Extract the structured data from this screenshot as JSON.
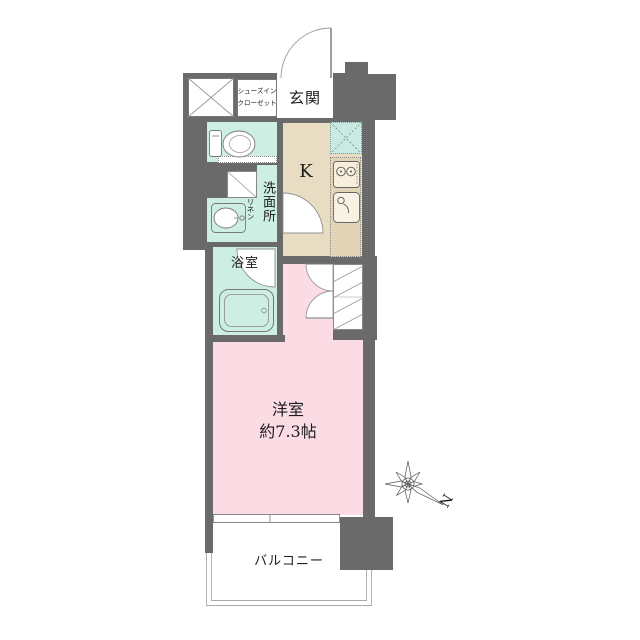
{
  "plan_title": "1K apartment floor plan",
  "labels": {
    "shoe_closet_line1": "シューズイン",
    "shoe_closet_line2": "クローゼット",
    "entrance": "玄関",
    "kitchen": "K",
    "washroom": "洗面所",
    "linen": "リネン",
    "bathroom": "浴室",
    "room_name": "洋室",
    "room_size": "約7.3帖",
    "balcony": "バルコニー",
    "north": "N"
  },
  "colors": {
    "wall": "#6a6a6a",
    "mint": "#cdeee2",
    "mint2": "#c8eae2",
    "beige": "#e8ddc3",
    "counter": "#e2d4b6",
    "pink": "#fbdce4",
    "line": "#8a8a8a",
    "text": "#1c1c1c"
  }
}
